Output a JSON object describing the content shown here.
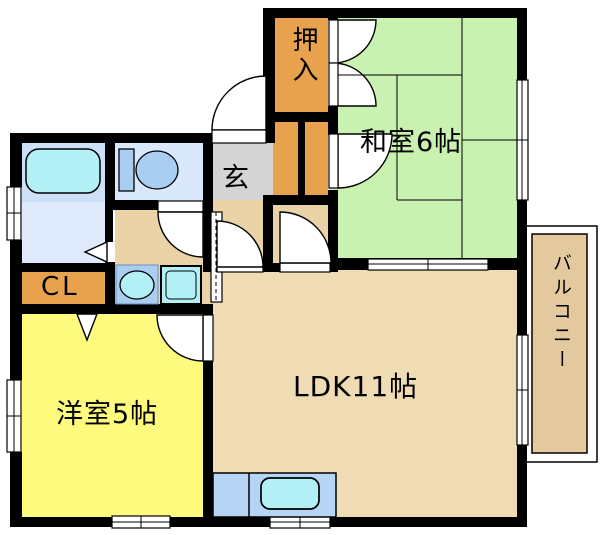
{
  "floorplan": {
    "rooms": {
      "washitsu": "和室6帖",
      "ldk": "LDK11帖",
      "yoshitsu": "洋室5帖",
      "genkan": "玄",
      "oshiire": "押入",
      "closet": "CL",
      "balcony": "バルコニー"
    },
    "colors": {
      "wall": "#000000",
      "washitsu": "#c9f2b0",
      "ldk": "#f0dcb4",
      "hall": "#ead3a6",
      "yoshitsu": "#fdfa7d",
      "storage": "#e8a24e",
      "genkan": "#d4d4d4",
      "balcony": "#e4c99f",
      "bath_room": "#cce0f8",
      "toilet_room": "#d9e9fb",
      "washroom": "#dfeafc",
      "fixture_blue": "#aacdf2",
      "fixture_cyan": "#b2f0f6",
      "kitchen": "#b6d4f4"
    }
  }
}
